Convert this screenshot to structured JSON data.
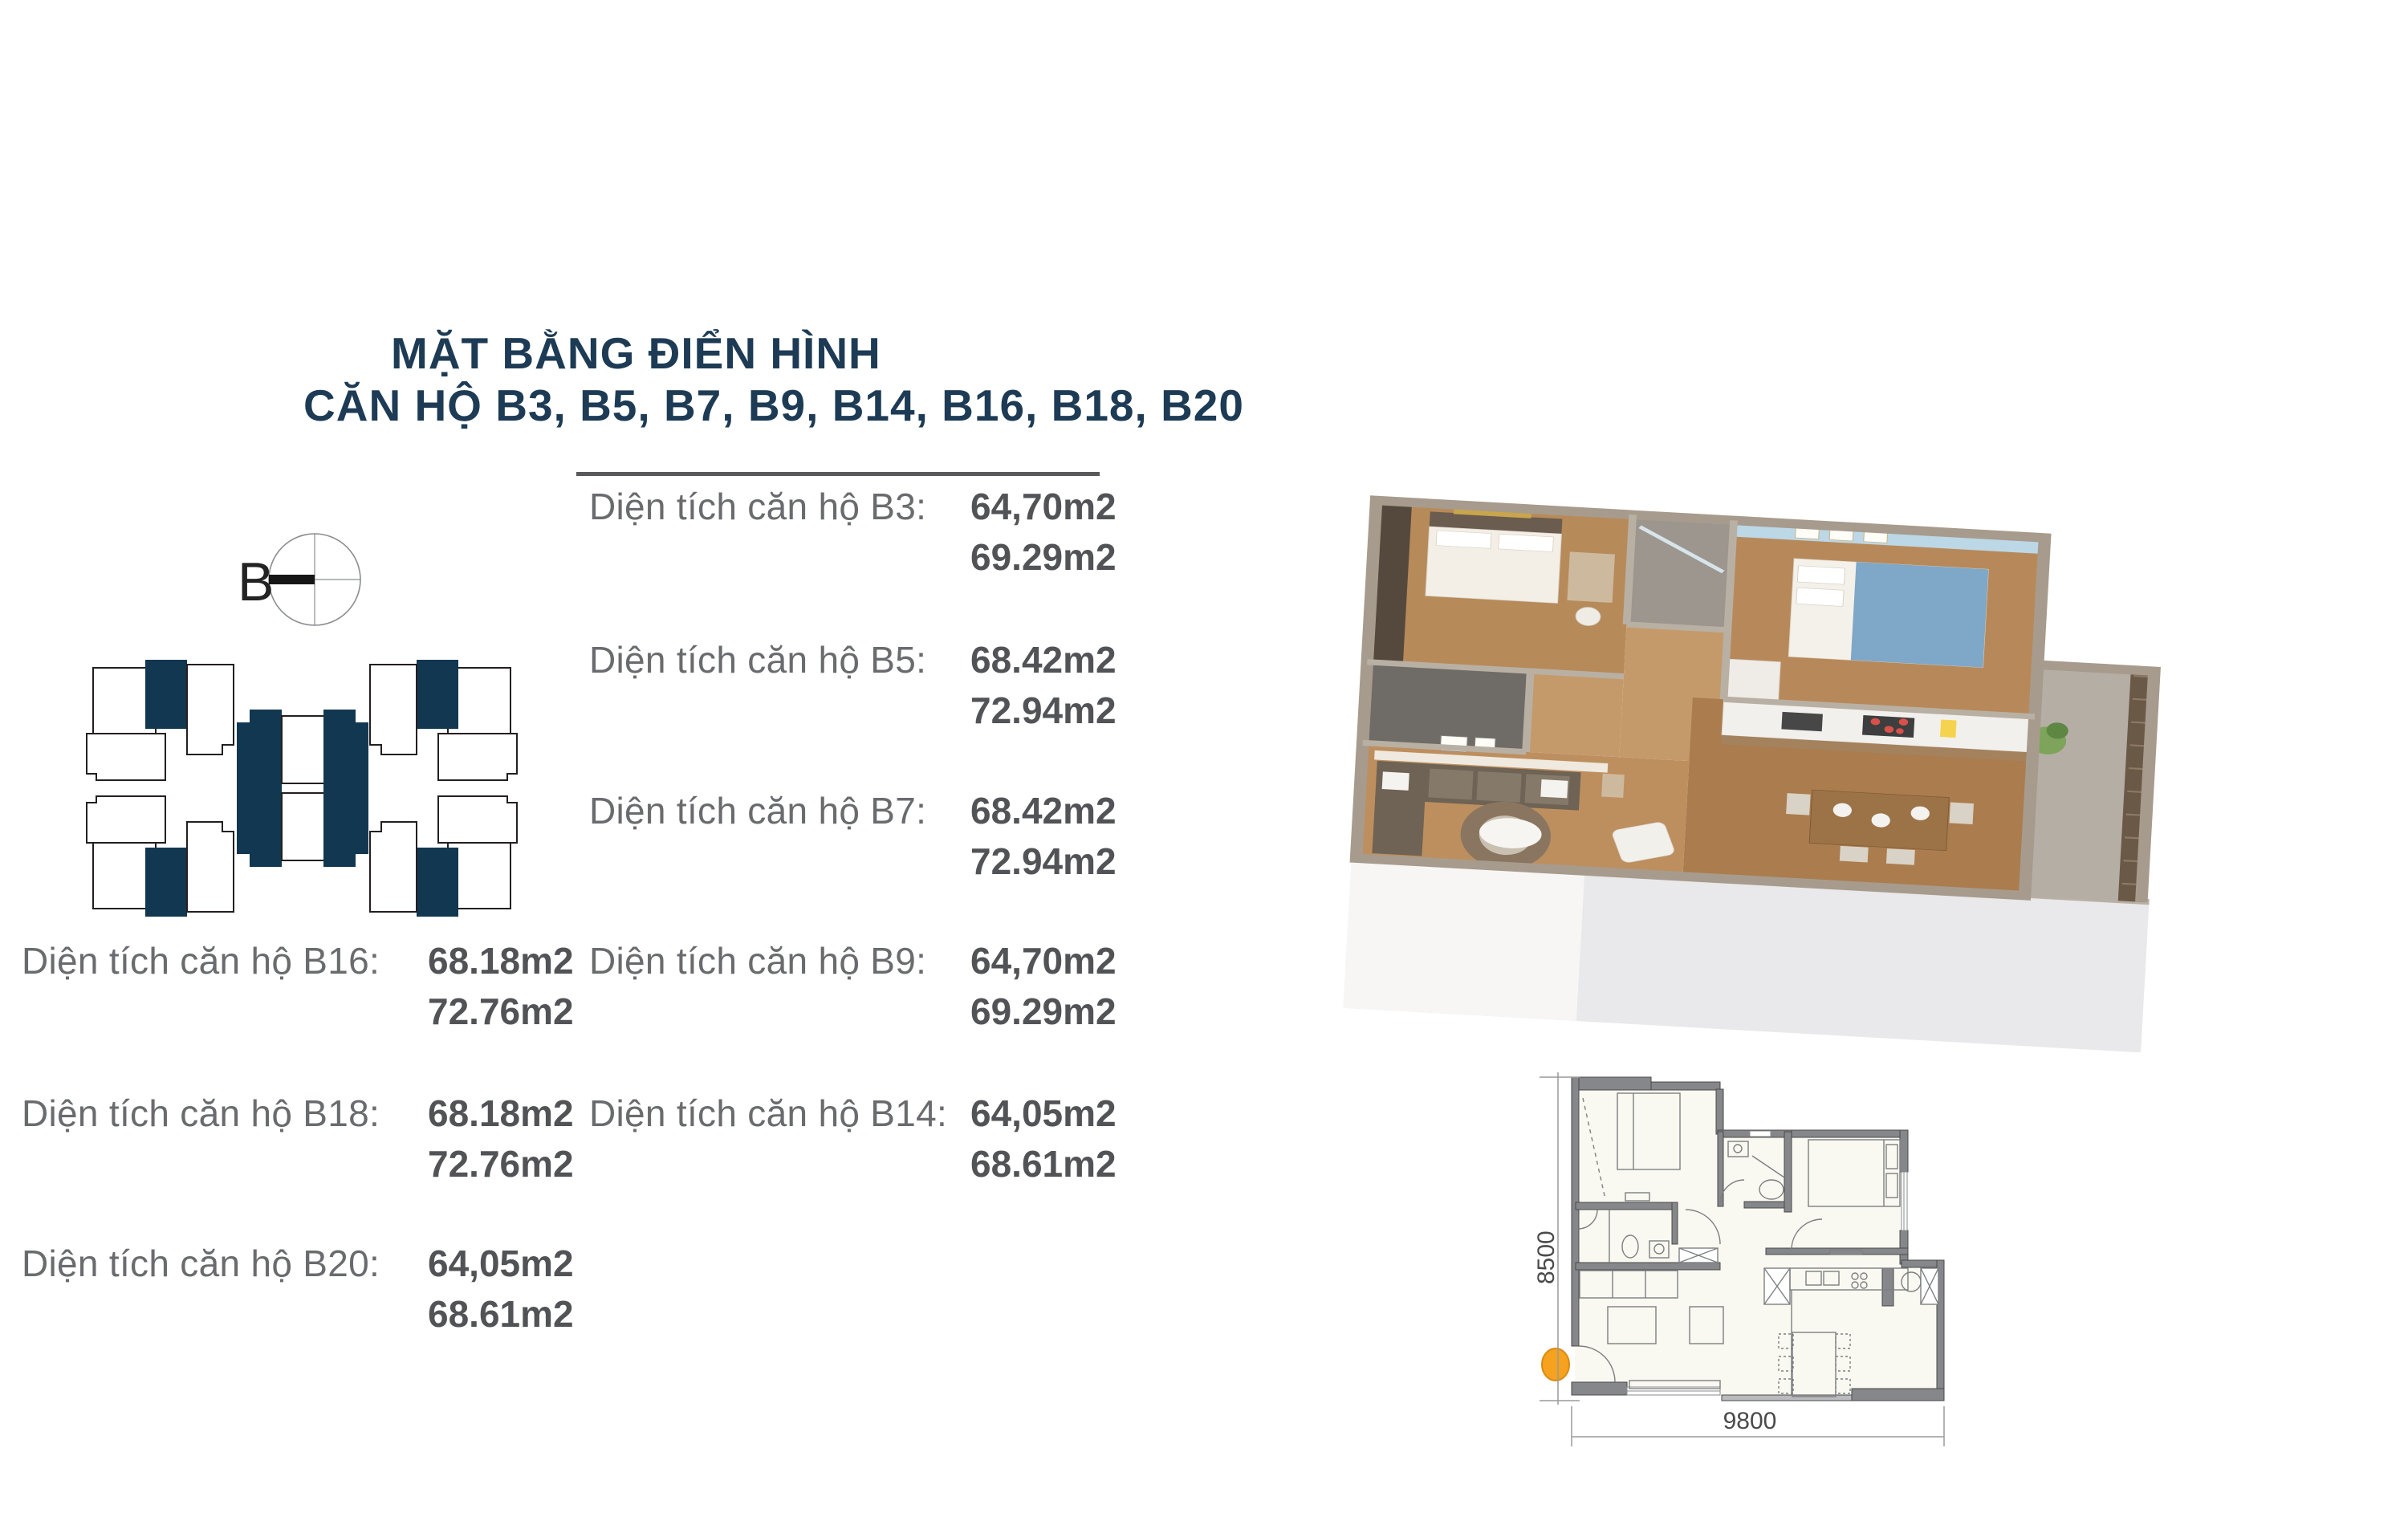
{
  "title": {
    "line1": "MẶT BẰNG ĐIỂN HÌNH",
    "line2": "CĂN HỘ B3, B5, B7, B9, B14, B16, B18, B20"
  },
  "compass": {
    "label": "B"
  },
  "colors": {
    "title_navy": "#1d3b55",
    "highlight_navy": "#123750",
    "label_gray": "#6a6b6e",
    "value_gray": "#525356",
    "entry_orange": "#F6A21E",
    "wall_gray": "#85878a"
  },
  "area_list": {
    "middle_column": [
      {
        "label": "Diện tích căn hộ B3:",
        "area1": "64,70m2",
        "area2": "69.29m2"
      },
      {
        "label": "Diện tích căn hộ B5:",
        "area1": "68.42m2",
        "area2": "72.94m2"
      },
      {
        "label": "Diện tích căn hộ B7:",
        "area1": "68.42m2",
        "area2": "72.94m2"
      },
      {
        "label": "Diện tích căn hộ B9:",
        "area1": "64,70m2",
        "area2": "69.29m2"
      },
      {
        "label": "Diện tích căn hộ B14:",
        "area1": "64,05m2",
        "area2": "68.61m2"
      }
    ],
    "left_column": [
      {
        "label": "Diện tích căn hộ B16:",
        "area1": "68.18m2",
        "area2": "72.76m2"
      },
      {
        "label": "Diện tích căn hộ B18:",
        "area1": "68.18m2",
        "area2": "72.76m2"
      },
      {
        "label": "Diện tích căn hộ B20:",
        "area1": "64,05m2",
        "area2": "68.61m2"
      }
    ]
  },
  "floor_plan": {
    "width_dim": "9800",
    "height_dim": "8500"
  }
}
